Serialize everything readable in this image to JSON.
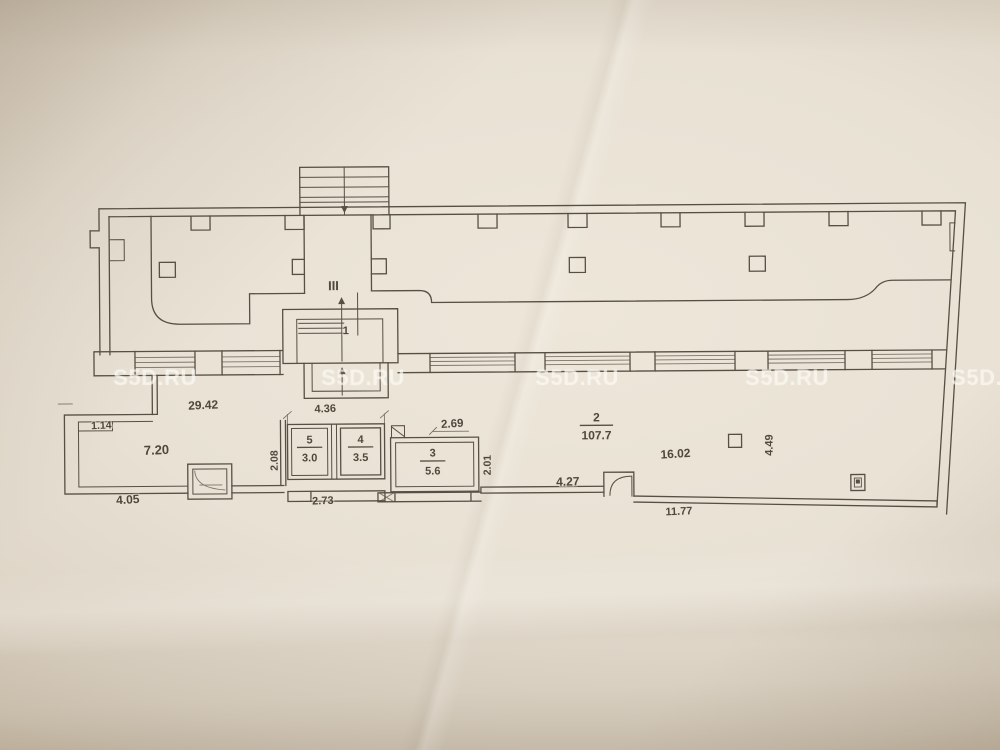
{
  "watermark": {
    "text": "S5D.RU"
  },
  "plan": {
    "stairwell_label": "III",
    "rooms": [
      {
        "number": "1"
      },
      {
        "number": "2",
        "area": "107.7"
      },
      {
        "number": "3",
        "area": "5.6"
      },
      {
        "number": "4",
        "area": "3.5"
      },
      {
        "number": "5",
        "area": "3.0"
      }
    ],
    "dimensions": [
      {
        "id": "top-width",
        "value": "29.42"
      },
      {
        "id": "left-niche",
        "value": "1.14"
      },
      {
        "id": "room-left-width",
        "value": "7.20"
      },
      {
        "id": "bottom-left",
        "value": "4.05"
      },
      {
        "id": "corridor-depth",
        "value": "2.08"
      },
      {
        "id": "rooms-4-5-width",
        "value": "4.36"
      },
      {
        "id": "rooms-4-5-bottom",
        "value": "2.73"
      },
      {
        "id": "room-3-width",
        "value": "2.69"
      },
      {
        "id": "room-3-depth",
        "value": "2.01"
      },
      {
        "id": "mid-bottom",
        "value": "4.27"
      },
      {
        "id": "right-width",
        "value": "16.02"
      },
      {
        "id": "right-depth",
        "value": "4.49"
      },
      {
        "id": "bottom-right",
        "value": "11.77"
      }
    ]
  }
}
